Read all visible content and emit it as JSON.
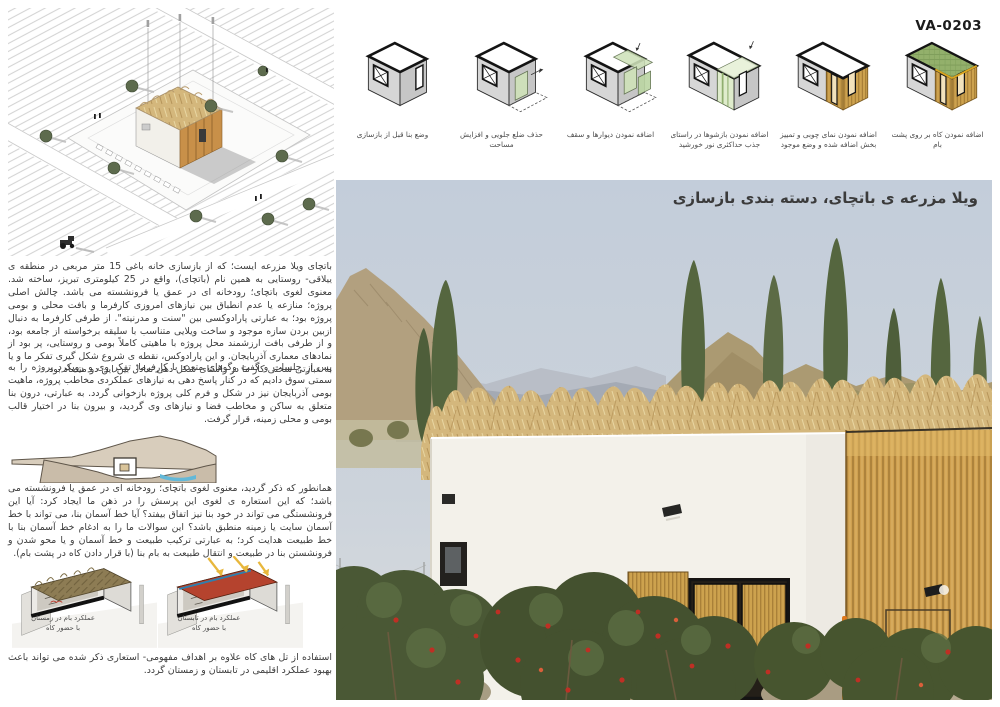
{
  "code": "VA-0203",
  "photo_title": "ویلا مزرعه ی باتچای، دسته بندی بازسازی",
  "steps": [
    {
      "label": "وضع بنا قبل از بازسازی"
    },
    {
      "label": "حذف ضلع جلویی و افزایش مساحت"
    },
    {
      "label": "اضافه نمودن دیوارها و سقف"
    },
    {
      "label": "اضافه نمودن بازشوها در راستای جذب حداکثری نور خورشید"
    },
    {
      "label": "اضافه نمودن نمای چوبی و تمییز بخش اضافه شده و وضع موجود"
    },
    {
      "label": "اضافه نمودن کاه بر روی پشت بام"
    }
  ],
  "paragraphs": {
    "p1": "باتچای ویلا مزرعه ایست؛ که از بازسازی خانه باغی 15 متر مربعی در منطقه ی ییلاقی- روستایی به همین نام (باتچای)، واقع در 25 کیلومتری تبریز، ساخته شد. معنوی لغوی باتچای؛ رودخانه ای در عمق یا فرونشسته می باشد. چالش اصلی پروژه؛ منازعه یا عدم انطباق بین نیازهای امروزی کارفرما و بافت محلی و بومی پروژه بود؛ به عبارتی پارادوکسی بین \"سنت و مدرنیته\". از طرفی کارفرما به دنبال ازبین بردن سازه موجود و ساخت ویلایی متناسب با سلیقه برخواسته از جامعه بود، و از طرفی بافت ارزشمند محل پروژه با ماهیتی کاملاً بومی و روستایی، پر بود از نمادهای معماری آذربایجان. و این پارادوکس، نقطه ی شروع شکل گیری تفکر ما و یا به عبارتی سختی کار ما در راستای شکل دهی تعادل بین این دو متضاد بود.",
    "p2": "پس از جلسات و گفت وگوهای متعدد با کارفرما؛ تفکر وی و رویکرد پروژه را به سمتی سوق دادیم که در کنار پاسخ دهی به نیازهای عملکردی مخاطب پروژه، ماهیت بومی آذربایجان نیز در شکل و فرم کلی پروژه بازخوانی گردد. به عبارتی، درون بنا متعلق به ساکن و مخاطب فضا و نیازهای وی گردید، و بیرون بنا در اختیار قالب بومی و محلی زمینه، قرار گرفت.",
    "p3": "همانطور که ذکر گردید، معنوی لغوی باتچای؛ رودخانه ای در عمق یا فرونشسته می باشد؛ که این استعاره ی لغوی این پرسش را در ذهن ما ایجاد کرد: آیا این فرونشستگی می تواند در خود بنا نیز اتفاق بیفتد؟ آیا خط آسمان بنا، می تواند با خط آسمان سایت یا زمینه منطبق باشد؟ این سوالات ما را به ادغام خط آسمان بنا با خط طبیعت هدایت کرد؛ به عبارتی ترکیب طبیعت و خط آسمان و یا محو شدن و فرونشستن بنا در طبیعت و انتقال طبیعت به بام بنا (با قرار دادن کاه در پشت بام).",
    "p4": "استفاده از تل های کاه علاوه بر اهداف مفهومی- استعاری ذکر شده می تواند باعث بهبود عملکرد اقلیمی در تابستان و زمستان گردد."
  },
  "roof_diagrams": {
    "winter": {
      "line1": "عملکرد بام در زمستان",
      "line2": "با حضور کاه"
    },
    "summer": {
      "line1": "عملکرد بام در تابستان",
      "line2": "با حضور کاه"
    }
  },
  "colors": {
    "wood": "#cfa050",
    "straw": "#d4b77c",
    "diagram_green": "#cfe2ba",
    "roof_green": "#93b06b",
    "summer_roof_red": "#b5432e",
    "text": "#3d3d3d"
  }
}
